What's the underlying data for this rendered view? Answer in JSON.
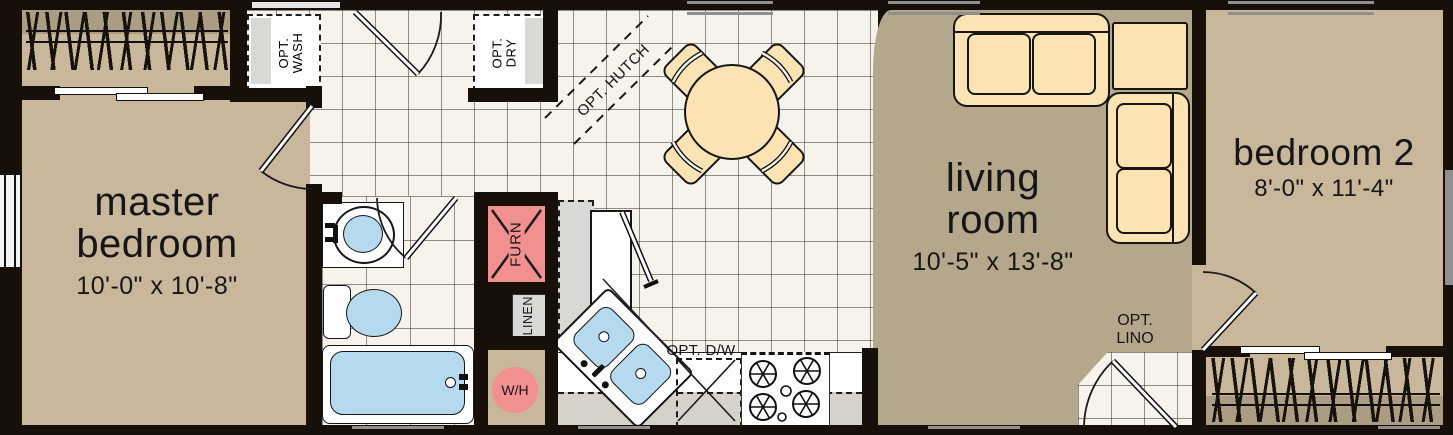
{
  "rooms": {
    "master_bedroom": {
      "line1": "master",
      "line2": "bedroom",
      "dims": "10'-0\" x 10'-8\""
    },
    "living_room": {
      "line1": "living",
      "line2": "room",
      "dims": "10'-5\" x 13'-8\""
    },
    "bedroom_2": {
      "name": "bedroom 2",
      "dims": "8'-0\" x 11'-4\""
    }
  },
  "labels": {
    "opt_wash": {
      "line1": "OPT.",
      "line2": "WASH"
    },
    "opt_dry": {
      "line1": "OPT.",
      "line2": "DRY"
    },
    "opt_hutch": "OPT. HUTCH",
    "furnace": "FURN",
    "linen": "LINEN",
    "water_heater": "W/H",
    "opt_dishwasher": "OPT. D/W",
    "opt_lino": {
      "line1": "OPT.",
      "line2": "LINO"
    }
  },
  "colors": {
    "wall": "#17100a",
    "bedroom_floor": "#c8b79b",
    "living_carpet": "#b5a78c",
    "tile": "#f5f3ec",
    "closet_band": "#ab9d83",
    "fixture_pink": "#f29090",
    "water_blue": "#b5d9ef",
    "furniture_cream": "#fbe3b3",
    "appliance_gray": "#d8d8d4",
    "window_gray": "#8f8f8f"
  }
}
